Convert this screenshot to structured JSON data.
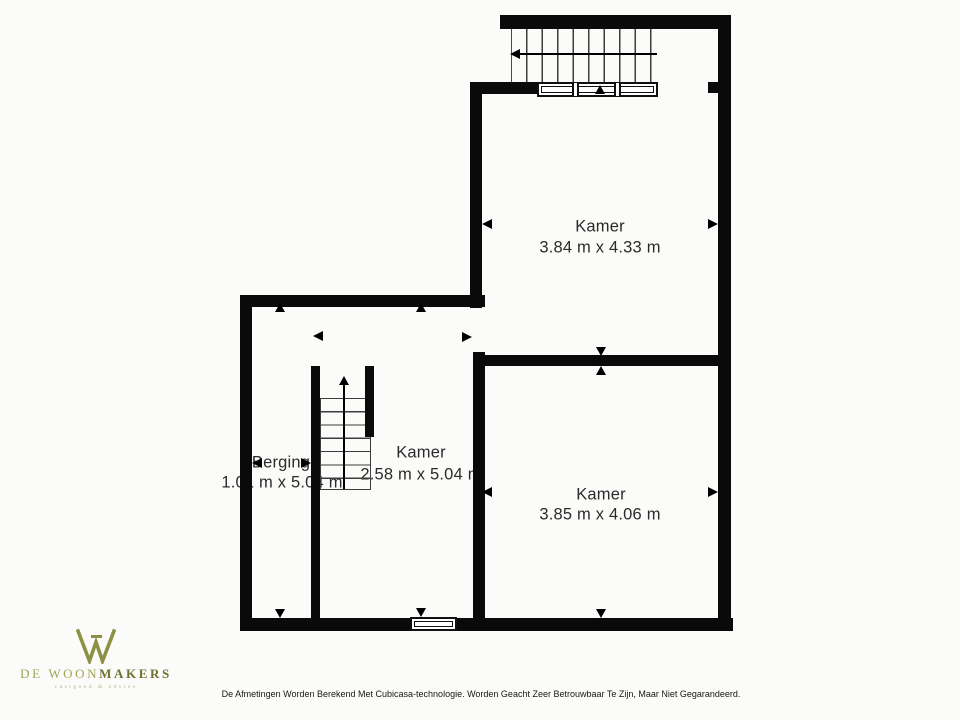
{
  "plan": {
    "rooms": [
      {
        "name": "Kamer",
        "dims": "3.84 m x 4.33 m"
      },
      {
        "name": "Kamer",
        "dims": "3.85 m x 4.06 m"
      },
      {
        "name": "Kamer",
        "dims": "2.58 m x 5.04 m"
      },
      {
        "name": "Berging",
        "dims": "1.01 m x 5.04 m"
      }
    ],
    "colors": {
      "wall": "#0a0a0a",
      "background": "#fbfbf9"
    }
  },
  "branding": {
    "name_light": "DE WOON",
    "name_bold": "MAKERS",
    "tagline": "vastgoed & advies",
    "color_light": "#a0a455",
    "color_dark": "#6d7130"
  },
  "footer": {
    "disclaimer": "De Afmetingen Worden Berekend Met Cubicasa-technologie. Worden Geacht Zeer Betrouwbaar Te Zijn, Maar Niet Gegarandeerd."
  }
}
